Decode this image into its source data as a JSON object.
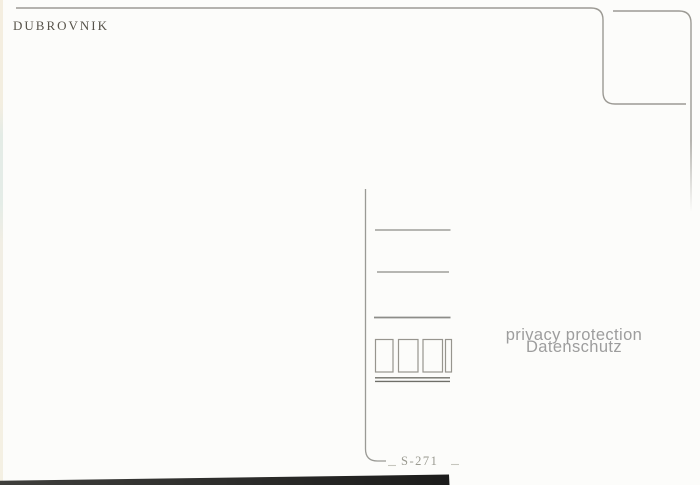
{
  "postcard": {
    "title": "DUBROVNIK",
    "watermark": {
      "line1": "privacy protection",
      "line2": "Datenschutz"
    },
    "serial_number": "S-271"
  },
  "colors": {
    "background": "#fcfcfa",
    "line": "#97958e",
    "divider": "#8f8f8a",
    "address_line": "#8d8d88",
    "rule_dark": "#6f6f68",
    "title_text": "#57534a",
    "watermark_text": "#9d9d9d",
    "serial_text": "#9a9a90",
    "pen_mark": "#c6c6be",
    "scan_band_left": "#3f3f3c",
    "scan_band_right": "#1c1c1b"
  }
}
